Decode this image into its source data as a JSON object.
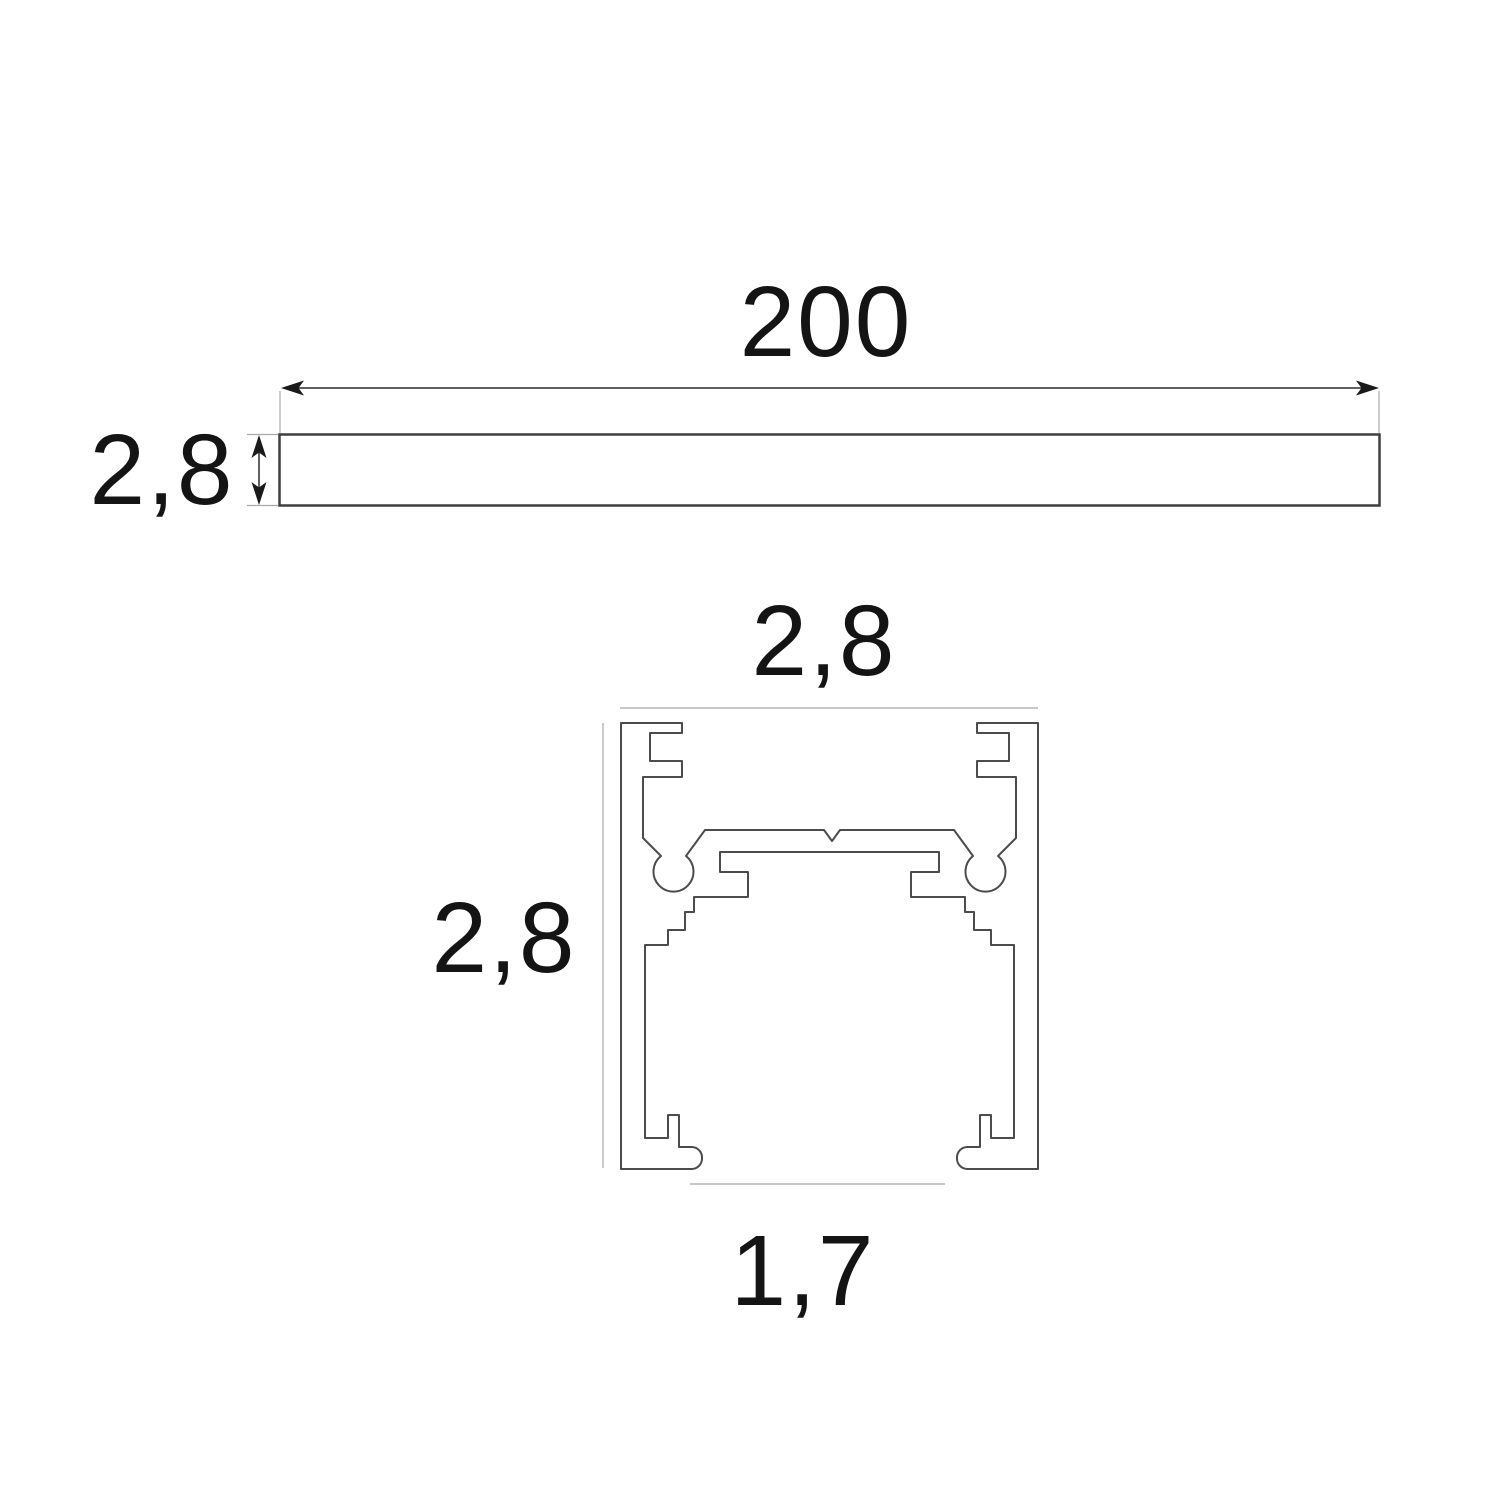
{
  "drawing": {
    "title": "profile-dimension-drawing",
    "top_view": {
      "length_label": "200",
      "height_label": "2,8"
    },
    "section_view": {
      "width_label": "2,8",
      "height_label": "2,8",
      "bottom_width_label": "1,7"
    },
    "colors": {
      "background": "#ffffff",
      "profile_outline": "#4c4c4c",
      "bar_outline": "#3f3f3f",
      "dimension_line": "#2b2b2b",
      "arrow_fill": "#1a1a1a",
      "extension_line": "#a8a8a8",
      "text": "#141414"
    }
  }
}
